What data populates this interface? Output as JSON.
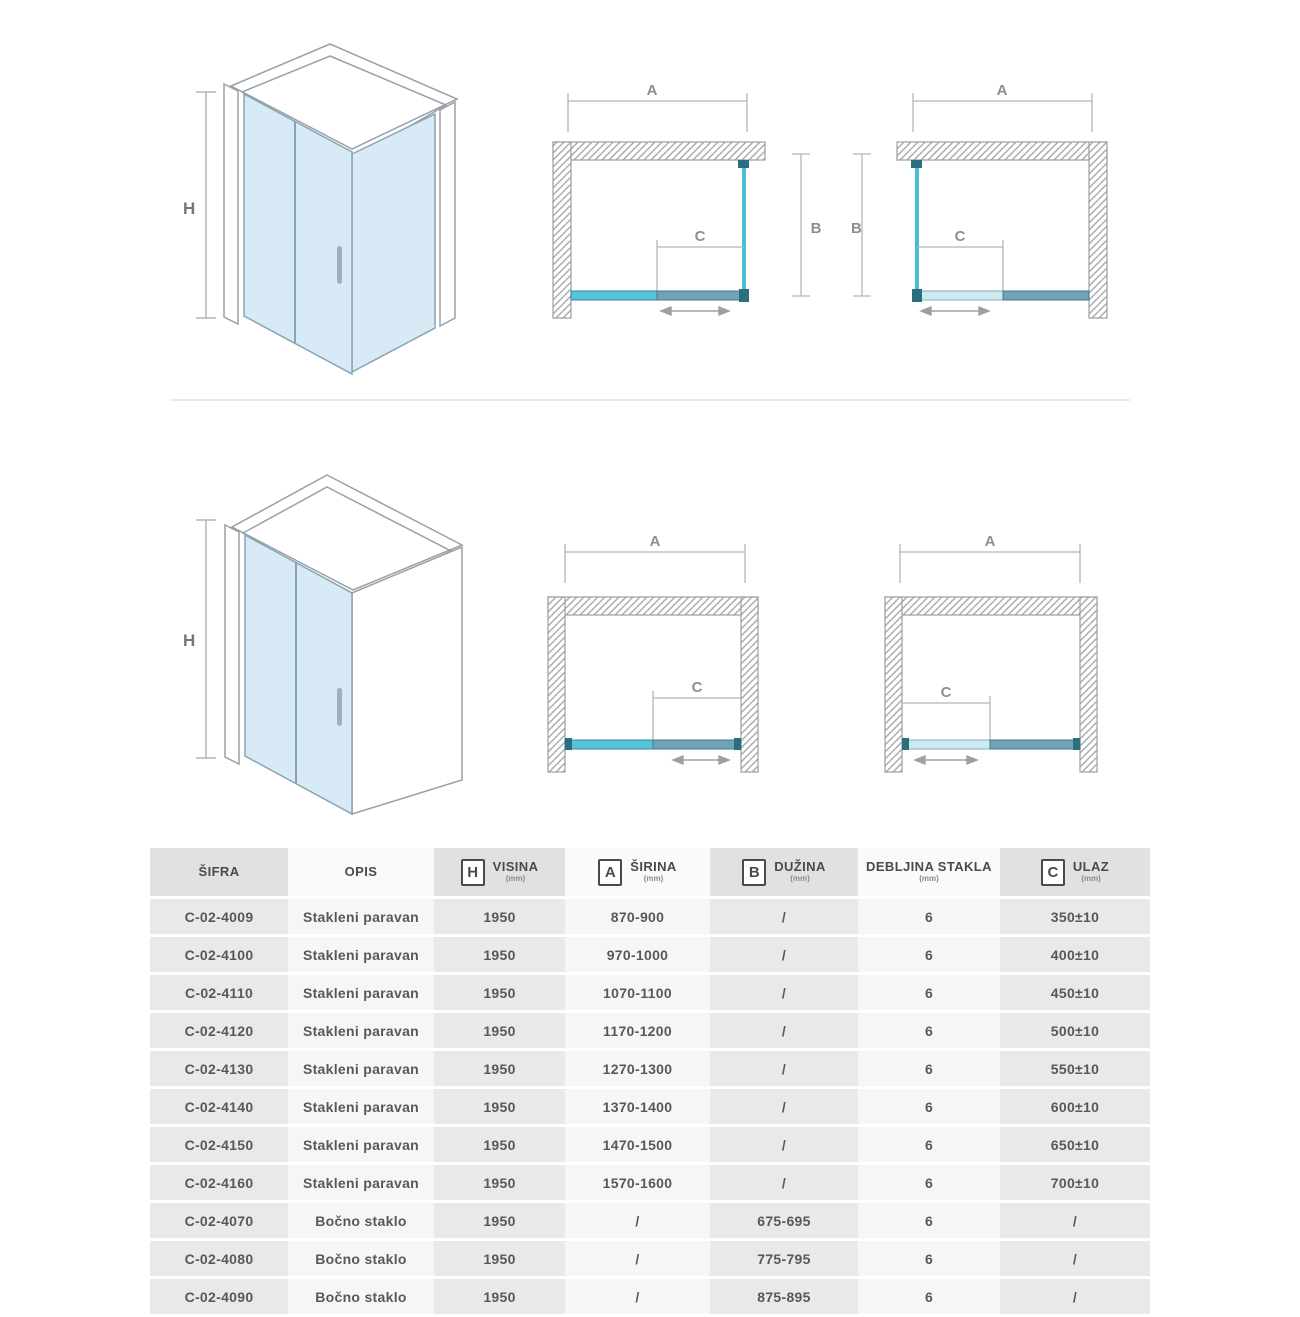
{
  "labels": {
    "h": "H",
    "a": "A",
    "b": "B",
    "c": "C"
  },
  "colors": {
    "glass_iso": "#d7eaf6",
    "glass_bright_cyan": "#57c3d8",
    "glass_steel": "#6fa3b8",
    "glass_pale": "#cfe9f0",
    "wall_outline": "#9aa0a4",
    "dimension_gray": "#b5b5b5"
  },
  "table": {
    "headers": [
      {
        "icon": "",
        "label": "ŠIFRA",
        "unit": ""
      },
      {
        "icon": "",
        "label": "OPIS",
        "unit": ""
      },
      {
        "icon": "H",
        "label": "VISINA",
        "unit": "(mm)"
      },
      {
        "icon": "A",
        "label": "ŠIRINA",
        "unit": "(mm)"
      },
      {
        "icon": "B",
        "label": "DUŽINA",
        "unit": "(mm)"
      },
      {
        "icon": "",
        "label": "DEBLJINA STAKLA",
        "unit": "(mm)"
      },
      {
        "icon": "C",
        "label": "ULAZ",
        "unit": "(mm)"
      }
    ],
    "rows": [
      [
        "C-02-4009",
        "Stakleni paravan",
        "1950",
        "870-900",
        "/",
        "6",
        "350±10"
      ],
      [
        "C-02-4100",
        "Stakleni paravan",
        "1950",
        "970-1000",
        "/",
        "6",
        "400±10"
      ],
      [
        "C-02-4110",
        "Stakleni paravan",
        "1950",
        "1070-1100",
        "/",
        "6",
        "450±10"
      ],
      [
        "C-02-4120",
        "Stakleni paravan",
        "1950",
        "1170-1200",
        "/",
        "6",
        "500±10"
      ],
      [
        "C-02-4130",
        "Stakleni paravan",
        "1950",
        "1270-1300",
        "/",
        "6",
        "550±10"
      ],
      [
        "C-02-4140",
        "Stakleni paravan",
        "1950",
        "1370-1400",
        "/",
        "6",
        "600±10"
      ],
      [
        "C-02-4150",
        "Stakleni paravan",
        "1950",
        "1470-1500",
        "/",
        "6",
        "650±10"
      ],
      [
        "C-02-4160",
        "Stakleni paravan",
        "1950",
        "1570-1600",
        "/",
        "6",
        "700±10"
      ],
      [
        "C-02-4070",
        "Bočno staklo",
        "1950",
        "/",
        "675-695",
        "6",
        "/"
      ],
      [
        "C-02-4080",
        "Bočno staklo",
        "1950",
        "/",
        "775-795",
        "6",
        "/"
      ],
      [
        "C-02-4090",
        "Bočno staklo",
        "1950",
        "/",
        "875-895",
        "6",
        "/"
      ]
    ]
  }
}
